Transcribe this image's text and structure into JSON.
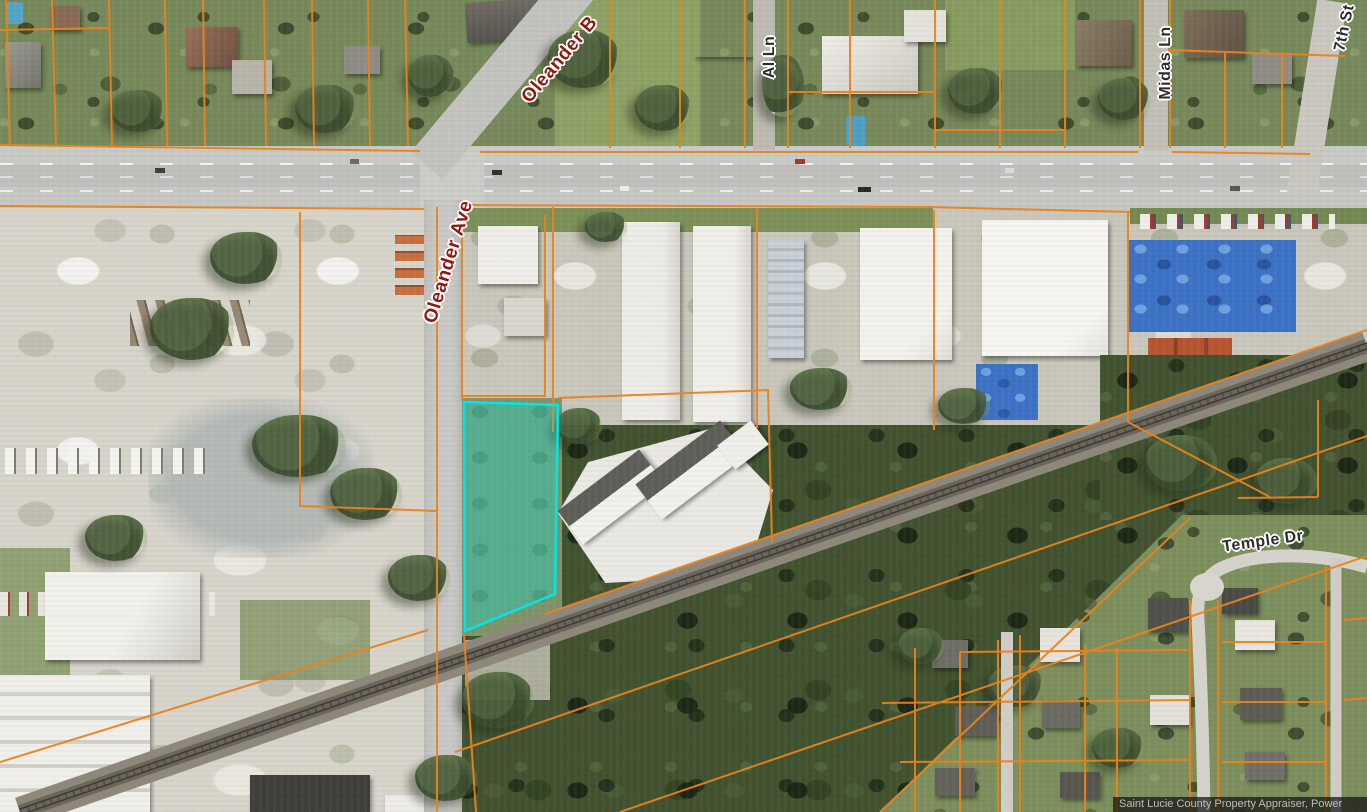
{
  "map": {
    "street_labels": [
      {
        "id": "oleander-blvd",
        "text": "Oleander B"
      },
      {
        "id": "oleander-ave",
        "text": "Oleander Ave"
      },
      {
        "id": "al-ln",
        "text": "Al Ln"
      },
      {
        "id": "midas-ln",
        "text": "Midas Ln"
      },
      {
        "id": "seventh-st",
        "text": "7th St"
      },
      {
        "id": "temple-dr",
        "text": "Temple Dr"
      }
    ],
    "attribution": "Saint Lucie County Property Appraiser,  Power",
    "colors": {
      "parcel_line": "#E8831C",
      "highlighted_parcel": "#00E6E6",
      "major_road_label": "#8E1912",
      "minor_road_label": "#2D2D2B"
    }
  }
}
